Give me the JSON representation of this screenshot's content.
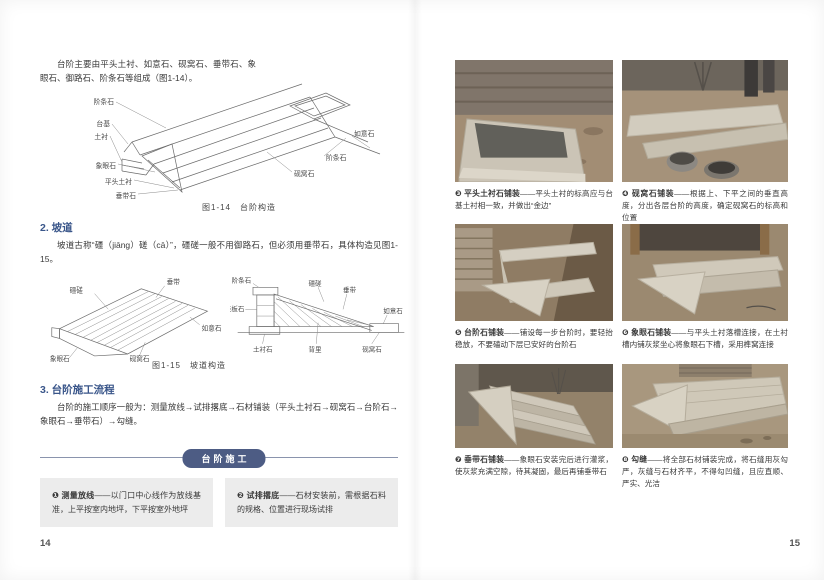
{
  "colors": {
    "heading_blue": "#3a568a",
    "banner_bg": "#4d5c84",
    "box_bg": "#ececec"
  },
  "page_left": {
    "page_number": "14",
    "intro": "台阶主要由平头土衬、如意石、砚窝石、垂带石、象眼石、御路石、阶条石等组成（图1-14）。",
    "fig14": {
      "caption": "图1-14　台阶构造",
      "labels_left": [
        "阶条石",
        "台基",
        "土衬",
        "象眼石",
        "平头土衬",
        "垂带石"
      ],
      "labels_right": [
        "如意石",
        "阶条石",
        "砚窝石"
      ]
    },
    "section2": {
      "heading": "2. 坡道",
      "body": "坡道古称“礓（jiāng）磋（cā）”，礓磋一般不用御路石，但必须用垂带石，具体构造见图1-15。"
    },
    "fig15": {
      "caption": "图1-15　坡道构造",
      "iso_labels": [
        "礓磋",
        "垂带",
        "如意石",
        "砚窝石",
        "象眼石"
      ],
      "sec_labels": [
        "阶条石",
        "陡板石",
        "礓磋",
        "垂带",
        "如意石",
        "土衬石",
        "背里",
        "砚窝石"
      ]
    },
    "section3": {
      "heading": "3. 台阶施工流程",
      "body": "台阶的施工顺序一般为：测量放线→试排撂底→石材铺装（平头土衬石→砚窝石→台阶石→象眼石→垂带石）→勾缝。"
    },
    "banner": "台阶施工",
    "steps": [
      {
        "num": "❶",
        "title": "测量放线",
        "desc": "——以门口中心线作为放线基准，上平按室内地坪，下平按室外地坪"
      },
      {
        "num": "❷",
        "title": "试排撂底",
        "desc": "——石材安装前，需根据石料的规格、位置进行现场试排"
      }
    ]
  },
  "page_right": {
    "page_number": "15",
    "photos": [
      {
        "num": "❸",
        "title": "平头土衬石铺装",
        "desc": "——平头土衬的标高应与台基土衬相一致，并做出“金边”"
      },
      {
        "num": "❹",
        "title": "砚窝石铺装",
        "desc": "——根据上、下平之间的垂直高度，分出各层台阶的高度，确定砚窝石的标高和位置"
      },
      {
        "num": "❺",
        "title": "台阶石铺装",
        "desc": "——铺设每一步台阶时，要轻抬稳放，不要磕动下层已安好的台阶石"
      },
      {
        "num": "❻",
        "title": "象眼石铺装",
        "desc": "——与平头土衬落槽连接，在土衬槽内铺灰浆坐心将象眼石下槽，采用榫窝连接"
      },
      {
        "num": "❼",
        "title": "垂带石铺装",
        "desc": "——象眼石安装完后进行灌浆，使灰浆充满空隙，待其凝固，最后再铺垂带石"
      },
      {
        "num": "❽",
        "title": "勾缝",
        "desc": "——将全部石材铺装完成，将石缝用灰勾严，灰缝与石材齐平，不得勾凹缝，且应直顺、严实、光洁"
      }
    ]
  }
}
